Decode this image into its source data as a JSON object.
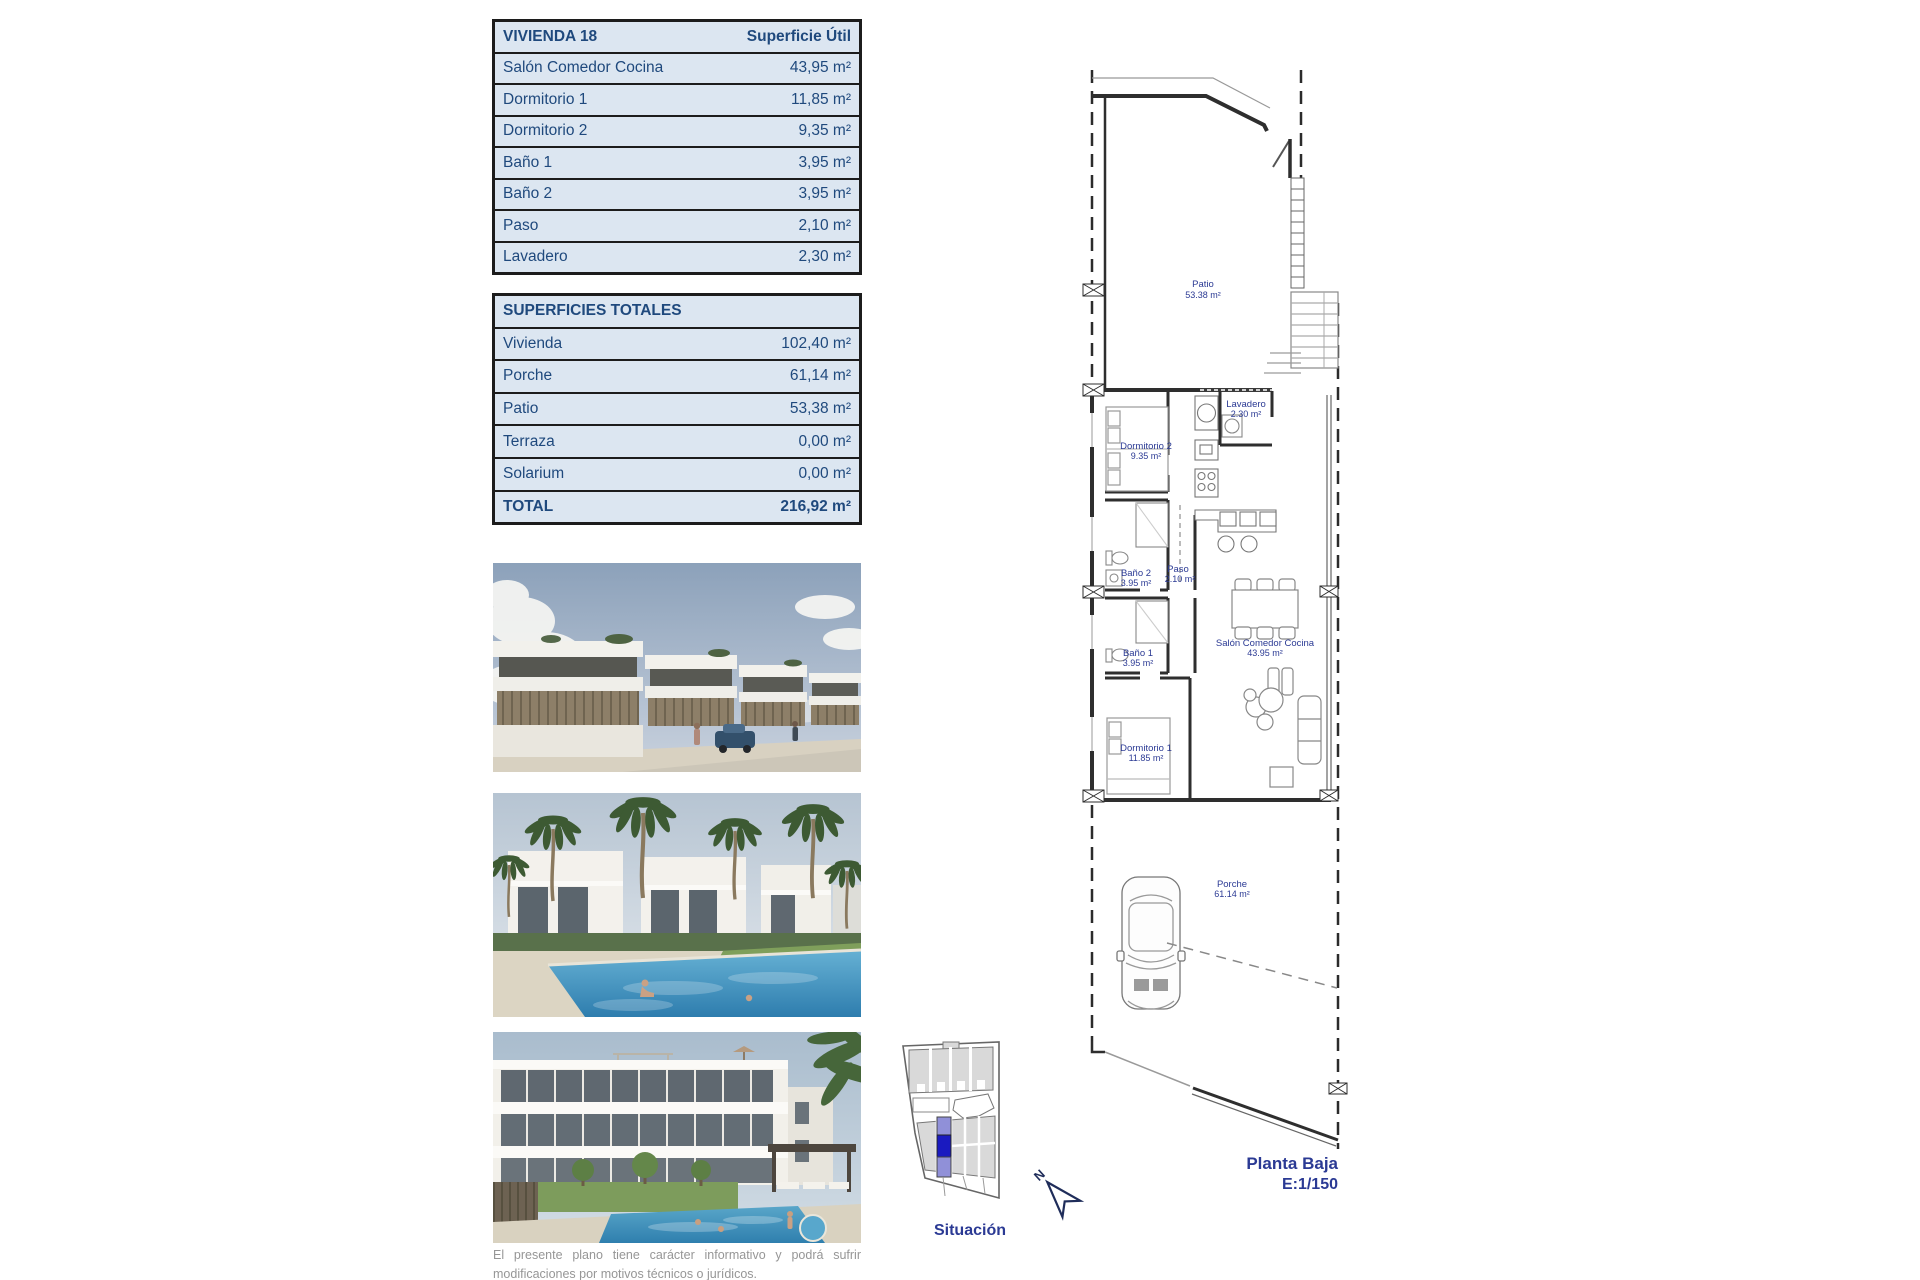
{
  "colors": {
    "table_bg": "#dce6f1",
    "table_text": "#1F497D",
    "table_border": "#1c1c1c",
    "plan_label_blue": "#2b3a94",
    "situ_highlight_dark": "#1a1ac0",
    "situ_highlight_light": "#9090d8",
    "situ_parcel_gray": "#d9d9d9"
  },
  "vivienda_table": {
    "title": "VIVIENDA 18",
    "header_value": "Superficie Útil",
    "rows": [
      {
        "label": "Salón Comedor Cocina",
        "value": "43,95 m²"
      },
      {
        "label": "Dormitorio 1",
        "value": "11,85 m²"
      },
      {
        "label": "Dormitorio 2",
        "value": "9,35 m²"
      },
      {
        "label": "Baño 1",
        "value": "3,95 m²"
      },
      {
        "label": "Baño 2",
        "value": "3,95 m²"
      },
      {
        "label": "Paso",
        "value": "2,10 m²"
      },
      {
        "label": "Lavadero",
        "value": "2,30 m²"
      }
    ]
  },
  "totals_table": {
    "title": "SUPERFICIES TOTALES",
    "rows": [
      {
        "label": "Vivienda",
        "value": "102,40 m²"
      },
      {
        "label": "Porche",
        "value": "61,14 m²"
      },
      {
        "label": "Patio",
        "value": "53,38 m²"
      },
      {
        "label": "Terraza",
        "value": "0,00 m²"
      },
      {
        "label": "Solarium",
        "value": "0,00 m²"
      }
    ],
    "total": {
      "label": "TOTAL",
      "value": "216,92 m²"
    }
  },
  "plan": {
    "rooms": {
      "patio": {
        "name": "Patio",
        "area": "53.38 m²"
      },
      "lavadero": {
        "name": "Lavadero",
        "area": "2.30 m²"
      },
      "dormitorio2": {
        "name": "Dormitorio 2",
        "area": "9.35 m²"
      },
      "bano2": {
        "name": "Baño 2",
        "area": "3.95 m²"
      },
      "paso": {
        "name": "Paso",
        "area": "2.10 m²"
      },
      "salon": {
        "name": "Salón Comedor Cocina",
        "area": "43.95 m²"
      },
      "bano1": {
        "name": "Baño 1",
        "area": "3.95 m²"
      },
      "dormitorio1": {
        "name": "Dormitorio 1",
        "area": "11.85 m²"
      },
      "porche": {
        "name": "Porche",
        "area": "61.14 m²"
      }
    },
    "title": "Planta Baja",
    "scale": "E:1/150"
  },
  "situation": {
    "label": "Situación",
    "north": "N"
  },
  "disclaimer": "El presente plano tiene carácter informativo y podrá sufrir modificaciones por motivos técnicos o jurídicos."
}
